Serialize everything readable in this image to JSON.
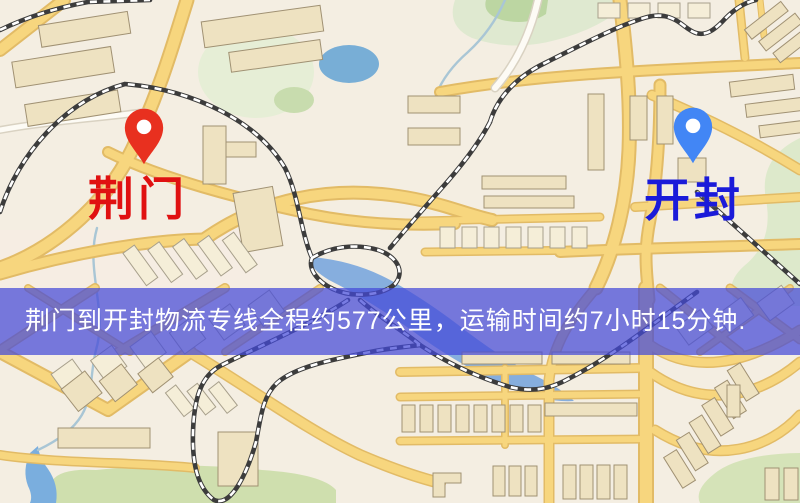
{
  "map": {
    "origin_marker": {
      "city": "荆门",
      "pin_color": "#e8301f",
      "label_color": "#e01111"
    },
    "destination_marker": {
      "city": "开封",
      "pin_color": "#4286f5",
      "label_color": "#1b1bd9"
    },
    "colors": {
      "background": "#f4eee2",
      "road_fill": "#f7d67e",
      "road_casing": "#e2bb66",
      "park_green": "#d2e1b2",
      "water_blue": "#7fb0d8",
      "building_beige": "#eee2c1",
      "railway_dark": "#3c3c3c",
      "banner_blue": "#454ad8"
    }
  },
  "banner": {
    "text": "荆门到开封物流专线全程约577公里，运输时间约7小时15分钟.",
    "text_color": "#ffffff"
  },
  "route_info": {
    "origin": "荆门",
    "destination": "开封",
    "distance_text": "全程约577公里",
    "duration_text": "运输时间约7小时15分钟"
  }
}
